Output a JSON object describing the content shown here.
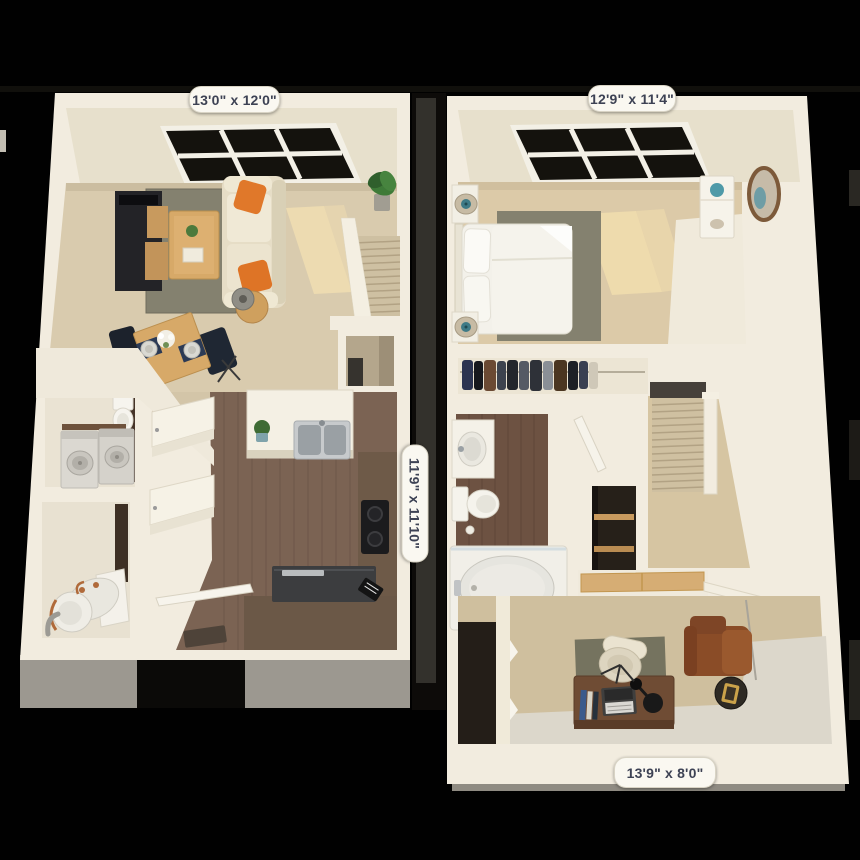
{
  "floorplan": {
    "first_floor": {
      "living_room_label": "13'0\" x 12'0\"",
      "kitchen_label": "11'9\" x 11'10\""
    },
    "second_floor": {
      "bedroom_label": "12'9\" x 11'4\"",
      "office_label": "13'9\" x 8'0\""
    },
    "palette": {
      "background": "#000000",
      "wall_cream": "#f2ecdf",
      "carpet_tan": "#d9cbae",
      "wood_floor_brown": "#7b6353",
      "light_wood": "#d7a968",
      "accent_orange": "#e0782a",
      "leather_brown": "#8a4c27",
      "rug_olive": "#84816f",
      "label_background": "#faf8f1",
      "label_text": "#3d4254"
    }
  }
}
